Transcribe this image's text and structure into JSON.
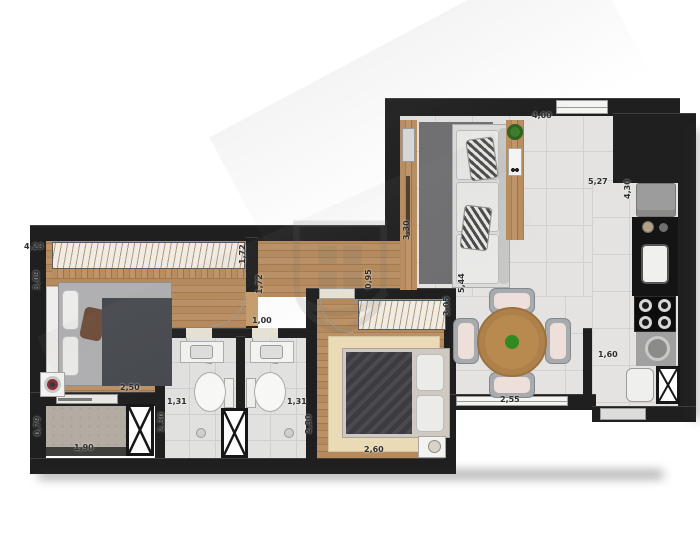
{
  "page": {
    "type": "apartment-floor-plan",
    "description": "Top-down rendered floor plan: two bedrooms, two bathrooms, living/dining room, kitchen strip, laundry nook and small balcony"
  },
  "colors": {
    "wall": "#1f1f1f",
    "floor_tile": "#e4e3e1",
    "floor_wood": "#b3875a",
    "balcony_concrete": "#b3aca2",
    "rug_beige": "#eadbb6",
    "rug_dark": "#6f6f71",
    "table_wood": "#b98a50",
    "plant_green": "#3e7d2c",
    "counter_black": "#141414",
    "appliance_gray": "#9c9c9c"
  },
  "watermark": {
    "name": "developer-shield-logo"
  },
  "dimensions": [
    {
      "label": "4,23",
      "x": 24,
      "y": 243,
      "rot": false
    },
    {
      "label": "3,09",
      "x": 33,
      "y": 290,
      "rot": true
    },
    {
      "label": "1,72",
      "x": 239,
      "y": 264,
      "rot": true
    },
    {
      "label": "1,72",
      "x": 256,
      "y": 294,
      "rot": true
    },
    {
      "label": "1,00",
      "x": 252,
      "y": 317,
      "rot": false
    },
    {
      "label": "2,50",
      "x": 120,
      "y": 384,
      "rot": false
    },
    {
      "label": "0,79",
      "x": 34,
      "y": 436,
      "rot": true
    },
    {
      "label": "1,90",
      "x": 74,
      "y": 444,
      "rot": false
    },
    {
      "label": "1,31",
      "x": 167,
      "y": 398,
      "rot": false
    },
    {
      "label": "2,30",
      "x": 158,
      "y": 432,
      "rot": true
    },
    {
      "label": "1,31",
      "x": 287,
      "y": 398,
      "rot": false
    },
    {
      "label": "2,30",
      "x": 305,
      "y": 434,
      "rot": true
    },
    {
      "label": "0,95",
      "x": 365,
      "y": 289,
      "rot": true
    },
    {
      "label": "3,30",
      "x": 403,
      "y": 240,
      "rot": true
    },
    {
      "label": "3,05",
      "x": 443,
      "y": 316,
      "rot": true
    },
    {
      "label": "2,60",
      "x": 364,
      "y": 446,
      "rot": false
    },
    {
      "label": "5,44",
      "x": 458,
      "y": 293,
      "rot": true
    },
    {
      "label": "2,55",
      "x": 500,
      "y": 396,
      "rot": false
    },
    {
      "label": "4,00",
      "x": 532,
      "y": 112,
      "rot": false
    },
    {
      "label": "5,27",
      "x": 588,
      "y": 178,
      "rot": false
    },
    {
      "label": "4,30",
      "x": 624,
      "y": 199,
      "rot": true
    },
    {
      "label": "1,60",
      "x": 598,
      "y": 351,
      "rot": false
    }
  ]
}
